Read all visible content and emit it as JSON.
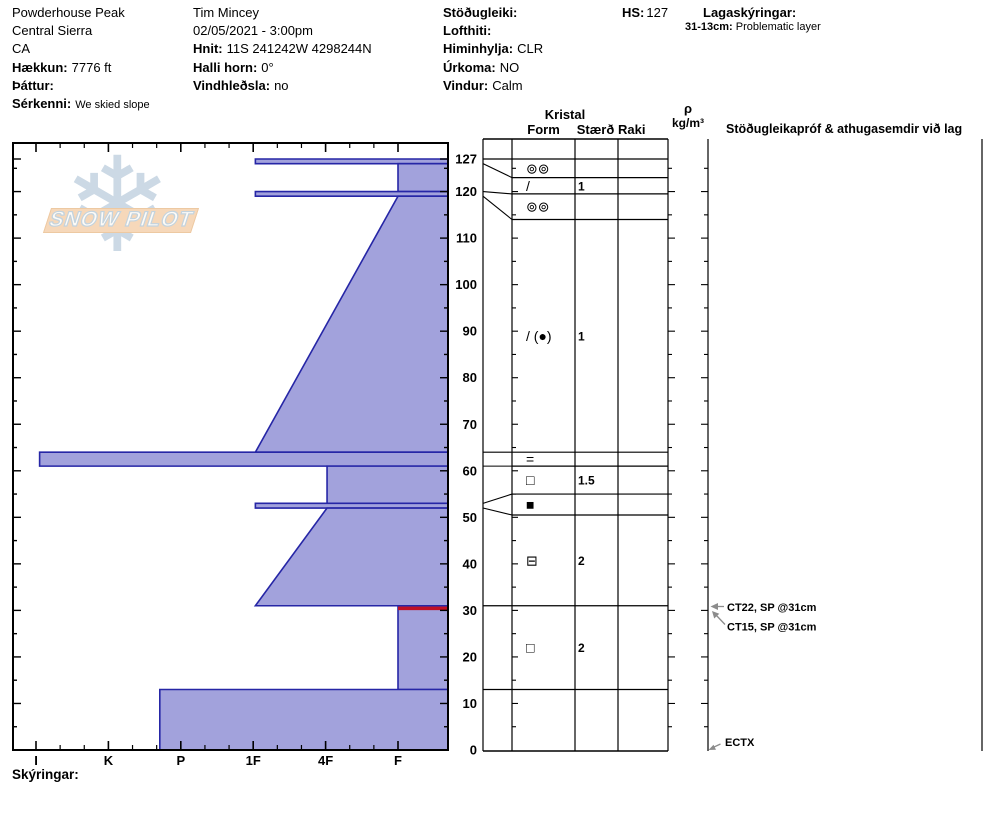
{
  "header": {
    "site": {
      "name": "Powderhouse Peak",
      "region": "Central Sierra",
      "state": "CA",
      "elevation_label": "Hækkun:",
      "elevation": "7776 ft",
      "aspect_label": "Þáttur:",
      "notes_label": "Sérkenni:",
      "notes": "We skied slope"
    },
    "observer": {
      "name": "Tim Mincey",
      "datetime": "02/05/2021 - 3:00pm",
      "coords_label": "Hnit:",
      "coords": "11S 241242W 4298244N",
      "slope_label": "Halli horn:",
      "slope": "0°",
      "windload_label": "Vindhleðsla:",
      "windload": "no"
    },
    "conditions": {
      "stability_label": "Stöðugleiki:",
      "airtemp_label": "Lofthiti:",
      "sky_label": "Himinhylja:",
      "sky": "CLR",
      "precip_label": "Úrkoma:",
      "precip": "NO",
      "wind_label": "Vindur:",
      "wind": "Calm"
    },
    "hs_label": "HS:",
    "hs": "127",
    "layer_notes_label": "Lagaskýringar:",
    "layer_note_range": "31-13cm:",
    "layer_note_text": "Problematic layer"
  },
  "logo": {
    "text": "SNOW PILOT",
    "flake": "❄"
  },
  "chart_data": {
    "type": "bar",
    "orientation": "horizontal-snow-hardness-profile",
    "title": "",
    "xlabel": "hand hardness",
    "ylabel": "depth (cm)",
    "ylim": [
      0,
      127
    ],
    "hardness_categories": [
      "I",
      "K",
      "P",
      "1F",
      "4F",
      "F"
    ],
    "depth_tick_labels": [
      127,
      120,
      110,
      100,
      90,
      80,
      70,
      60,
      50,
      40,
      30,
      20,
      10,
      0
    ],
    "layers": [
      {
        "top": 127,
        "bottom": 126,
        "hardness": "1F",
        "h_top": 3.03,
        "h_bot": 3.03
      },
      {
        "top": 126,
        "bottom": 120,
        "hardness": "F",
        "h_top": 5.0,
        "h_bot": 5.0
      },
      {
        "top": 120,
        "bottom": 119,
        "hardness": "1F",
        "h_top": 3.03,
        "h_bot": 3.03
      },
      {
        "top": 119,
        "bottom": 64,
        "hardness": "F to 1F",
        "h_top": 5.0,
        "h_bot": 3.03
      },
      {
        "top": 64,
        "bottom": 61,
        "hardness": "I",
        "h_top": 0.05,
        "h_bot": 0.05
      },
      {
        "top": 61,
        "bottom": 53,
        "hardness": "4F",
        "h_top": 4.02,
        "h_bot": 4.02
      },
      {
        "top": 53,
        "bottom": 52,
        "hardness": "1F",
        "h_top": 3.03,
        "h_bot": 3.03
      },
      {
        "top": 52,
        "bottom": 31,
        "hardness": "4F to 1F",
        "h_top": 4.02,
        "h_bot": 3.03
      },
      {
        "top": 31,
        "bottom": 13,
        "hardness": "F",
        "h_top": 5.0,
        "h_bot": 5.0,
        "flagged": true
      },
      {
        "top": 13,
        "bottom": 0,
        "hardness": "P+",
        "h_top": 1.71,
        "h_bot": 1.71
      }
    ],
    "flag_line": {
      "depth": 31,
      "from_hardness": "F",
      "h": 5.0
    }
  },
  "grain_table": {
    "header_group": "Kristal",
    "col_form": "Form",
    "col_size": "Stærð",
    "col_wet": "Raki",
    "col_density_sym": "ρ",
    "col_density_unit": "kg/m³",
    "col_tests": "Stöðugleikapróf & athugasemdir við lag",
    "rows": [
      {
        "row_top": 127,
        "row_bot": 123,
        "form": "⊚⊚",
        "size": "",
        "wet": ""
      },
      {
        "row_top": 123,
        "row_bot": 119.5,
        "form": "/",
        "size": "1",
        "wet": ""
      },
      {
        "row_top": 119.5,
        "row_bot": 114,
        "form": "⊚⊚",
        "size": "",
        "wet": ""
      },
      {
        "row_top": 114,
        "row_bot": 64,
        "form": "/ (●)",
        "size": "1",
        "wet": ""
      },
      {
        "row_top": 64,
        "row_bot": 61,
        "form": "=",
        "size": "",
        "wet": ""
      },
      {
        "row_top": 61,
        "row_bot": 55,
        "form": "□",
        "size": "1.5",
        "wet": ""
      },
      {
        "row_top": 55,
        "row_bot": 50.5,
        "form": "■",
        "size": "",
        "wet": ""
      },
      {
        "row_top": 50.5,
        "row_bot": 31,
        "form": "⊟",
        "size": "2",
        "wet": ""
      },
      {
        "row_top": 31,
        "row_bot": 13,
        "form": "□",
        "size": "2",
        "wet": ""
      },
      {
        "row_top": 13,
        "row_bot": 0,
        "form": "",
        "size": "",
        "wet": ""
      }
    ],
    "connectors": [
      {
        "chart_depth": 126,
        "row_depth": 123
      },
      {
        "chart_depth": 120,
        "row_depth": 119.5
      },
      {
        "chart_depth": 119,
        "row_depth": 114
      },
      {
        "chart_depth": 64,
        "row_depth": 64
      },
      {
        "chart_depth": 61,
        "row_depth": 61
      },
      {
        "chart_depth": 53,
        "row_depth": 55
      },
      {
        "chart_depth": 52,
        "row_depth": 50.5
      }
    ],
    "full_width_lines": [
      127,
      31,
      13
    ]
  },
  "annotations": [
    {
      "text": "CT22, SP @31cm",
      "depth": 31,
      "kind": "horizontal"
    },
    {
      "text": "CT15, SP @31cm",
      "depth": 31,
      "kind": "diagonal"
    },
    {
      "text": "ECTX",
      "depth": 0,
      "kind": "diagonal"
    }
  ],
  "footer": {
    "notes_label": "Skýringar:"
  },
  "colors": {
    "bar_fill": "#a2a2dc",
    "bar_border": "#2626a6",
    "flag_red": "#c01025",
    "arrow_gray": "#8c8c8c",
    "frame": "#000000"
  }
}
